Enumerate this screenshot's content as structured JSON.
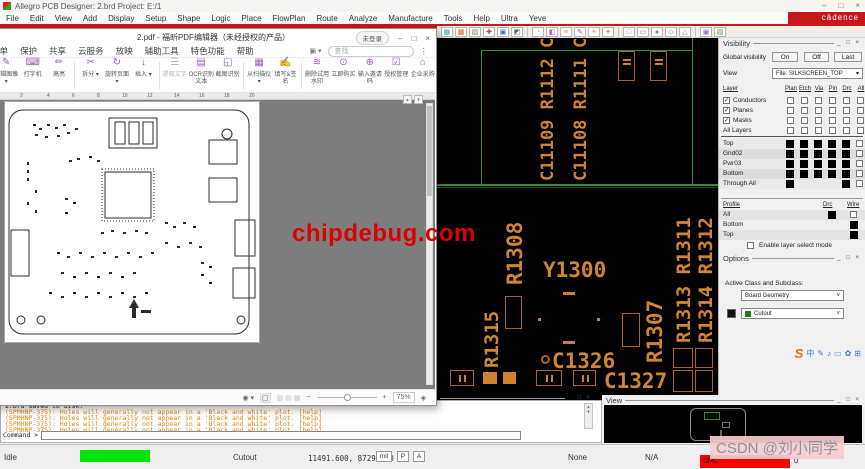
{
  "colors": {
    "accent_red": "#c8161d",
    "silkscreen_orange": "#d08532",
    "board_outline_green": "#2f8f2f",
    "progress_green": "#00e400",
    "drc_red": "#ff0000"
  },
  "watermarks": {
    "chipdebug": "chipdebug.com",
    "csdn": "CSDN @刘小同学"
  },
  "allegro": {
    "title": "Allegro PCB Designer: 2.brd  Project: E:/1",
    "window_controls": [
      "–",
      "□",
      "×"
    ],
    "brand": "cādence",
    "menus": [
      "File",
      "Edit",
      "View",
      "Add",
      "Display",
      "Setup",
      "Shape",
      "Logic",
      "Place",
      "FlowPlan",
      "Route",
      "Analyze",
      "Manufacture",
      "Tools",
      "Help",
      "Ultra",
      "Yeve"
    ],
    "toolbar_icon_groups": [
      [
        {
          "g": "▦",
          "c": "#2aada8"
        },
        {
          "g": "▩",
          "c": "#d95f2b"
        },
        {
          "g": "▧",
          "c": "#4a9e4a"
        },
        {
          "g": "✚",
          "c": "#c43b3b"
        },
        {
          "g": "▣",
          "c": "#3b6fc4"
        },
        {
          "g": "◩",
          "c": "#2e7d4f"
        }
      ],
      [
        {
          "g": "◔",
          "c": "#e0a12f"
        },
        {
          "g": "◧",
          "c": "#c45fb0"
        },
        {
          "g": "≡",
          "c": "#b8a22f"
        },
        {
          "g": "✎",
          "c": "#c43b3b"
        },
        {
          "g": "☀",
          "c": "#d8b62f"
        },
        {
          "g": "✦",
          "c": "#d98a2f"
        }
      ],
      [
        {
          "g": "□",
          "c": "#5b86c7"
        },
        {
          "g": "▭",
          "c": "#5b86c7"
        },
        {
          "g": "●",
          "c": "#5b86c7"
        },
        {
          "g": "◇",
          "c": "#5b86c7"
        },
        {
          "g": "△",
          "c": "#5b86c7"
        }
      ],
      [
        {
          "g": "▣",
          "c": "#8a6fc0"
        },
        {
          "g": "▤",
          "c": "#4a9e4a"
        }
      ]
    ],
    "canvas_labels": {
      "col1": "C11109 R1112 C1110",
      "col2": "C11108 R1111 C1111",
      "r1308": "R1308",
      "y1300": "Y1300",
      "r1315": "R1315",
      "c1326": "C1326",
      "c1327": "C1327",
      "r1307": "R1307",
      "col3": "R1313 R1311",
      "col4": "R1314 R1312"
    },
    "visibility": {
      "title": "Visibility",
      "window_buttons": "_ □ ×",
      "global_label": "Global visibility",
      "global_buttons": [
        "On",
        "Off",
        "Last"
      ],
      "view_label": "View",
      "view_value": "File: SILKSCREEN_TOP",
      "layer_header": "Layer",
      "grid_headers": [
        "Plan",
        "Etch",
        "Via",
        "Pin",
        "Drc",
        "All"
      ],
      "class_rows": [
        {
          "label": "Conductors",
          "checked": true
        },
        {
          "label": "Planes",
          "checked": true
        },
        {
          "label": "Masks",
          "checked": true
        },
        {
          "label": "All Layers",
          "checked": null
        }
      ],
      "layer_rows": [
        {
          "label": "Top",
          "cells": [
            1,
            1,
            1,
            1,
            1,
            0
          ]
        },
        {
          "label": "Gnd02",
          "cells": [
            1,
            1,
            1,
            1,
            1,
            0
          ]
        },
        {
          "label": "Pwr03",
          "cells": [
            1,
            1,
            1,
            1,
            1,
            0
          ]
        },
        {
          "label": "Bottom",
          "cells": [
            1,
            1,
            1,
            1,
            1,
            0
          ]
        },
        {
          "label": "Through All",
          "cells": [
            1,
            -1,
            -1,
            -1,
            1,
            0
          ]
        }
      ],
      "profile_header": "Profile",
      "profile_cols": [
        "Drc",
        "Wire"
      ],
      "profile_rows": [
        {
          "label": "All",
          "drc": 1,
          "wire": 0
        },
        {
          "label": "Bottom",
          "drc": -1,
          "wire": 1
        },
        {
          "label": "Top",
          "drc": -1,
          "wire": 1
        }
      ],
      "enable_label": "Enable layer select mode"
    },
    "options": {
      "title": "Options",
      "window_buttons": "_ □ ×",
      "active_label": "Active Class and Subclass:",
      "class_value": "Board Geometry",
      "subclass_value": "Cutout"
    },
    "view_panel": {
      "title": "View",
      "window_buttons": "_ □ ×"
    },
    "console": {
      "saved_line": "2.brd  saved to disk.",
      "warning_line": "(SPMHNP-375): Holes will generally not appear in a 'Black and white' plot.  [help]",
      "warning_count": 4,
      "prompt": "Command >"
    },
    "status": {
      "mode": "Idle",
      "command": "Cutout",
      "coords": "11491.600, 8729.000",
      "buttons": [
        "mil",
        "P",
        "A"
      ],
      "filter": "None",
      "na": "N/A",
      "drc_label": "DRC",
      "drc_count": "0"
    }
  },
  "pdf": {
    "title": "2.pdf - 福昕PDF编辑器（未经授权的产品）",
    "login_button": "未登录",
    "window_controls": [
      "–",
      "□",
      "×"
    ],
    "menus": [
      "表单",
      "保护",
      "共享",
      "云服务",
      "放映",
      "辅助工具",
      "特色功能",
      "帮助"
    ],
    "search_placeholder": "查找",
    "more_button": "⋮",
    "toolbar_groups": [
      [
        {
          "label": "编辑图像",
          "icon": "✎",
          "caret": true
        },
        {
          "label": "打字机",
          "icon": "⌨",
          "caret": false
        },
        {
          "label": "高亮",
          "icon": "✏",
          "caret": false
        }
      ],
      [
        {
          "label": "拆分",
          "icon": "✂",
          "caret": true
        },
        {
          "label": "旋转页面",
          "icon": "↻",
          "caret": true
        },
        {
          "label": "插入",
          "icon": "↓",
          "caret": true
        }
      ],
      [
        {
          "label": "提取文字",
          "icon": "☰",
          "caret": false,
          "disabled": true
        },
        {
          "label": "OCR识别文本",
          "icon": "▤",
          "caret": false
        },
        {
          "label": "截图识别",
          "icon": "◱",
          "caret": false
        }
      ],
      [
        {
          "label": "从扫描仪",
          "icon": "▦",
          "caret": true
        },
        {
          "label": "填写&签名",
          "icon": "✍",
          "caret": false
        }
      ],
      [
        {
          "label": "删除试用水印",
          "icon": "≋",
          "caret": false
        },
        {
          "label": "立即购买",
          "icon": "⊙",
          "caret": false
        },
        {
          "label": "输入邀请码",
          "icon": "⊕",
          "caret": false
        },
        {
          "label": "授权管理",
          "icon": "☑",
          "caret": false
        },
        {
          "label": "企业采购",
          "icon": "⌂",
          "caret": false
        }
      ]
    ],
    "ruler_numbers": [
      "2",
      "4",
      "6",
      "8",
      "10",
      "12",
      "14",
      "16",
      "18",
      "20"
    ],
    "zoom_value": "75%"
  }
}
